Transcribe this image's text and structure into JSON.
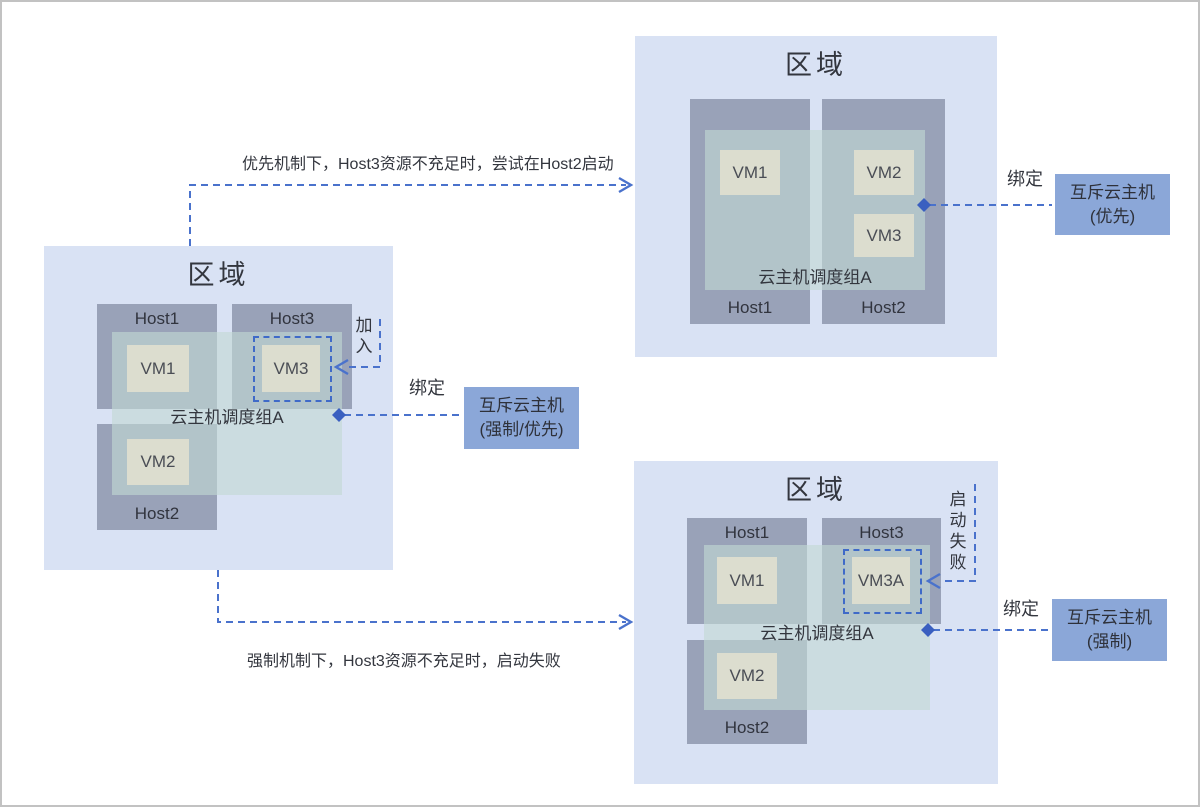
{
  "notes": {
    "priority": "优先机制下，Host3资源不充足时，尝试在Host2启动",
    "mandatory": "强制机制下，Host3资源不充足时，启动失败"
  },
  "labels": {
    "bind": "绑定",
    "join": "加入",
    "start_fail": "启动失败"
  },
  "zones": {
    "left": {
      "title": "区域",
      "group": "云主机调度组A",
      "hosts": {
        "host1": "Host1",
        "host2": "Host2",
        "host3": "Host3"
      },
      "vms": {
        "vm1": "VM1",
        "vm2": "VM2",
        "vm3": "VM3"
      }
    },
    "top_right": {
      "title": "区域",
      "group": "云主机调度组A",
      "hosts": {
        "host1": "Host1",
        "host2": "Host2"
      },
      "vms": {
        "vm1": "VM1",
        "vm2": "VM2",
        "vm3": "VM3"
      }
    },
    "bottom_right": {
      "title": "区域",
      "group": "云主机调度组A",
      "hosts": {
        "host1": "Host1",
        "host2": "Host2",
        "host3": "Host3"
      },
      "vms": {
        "vm1": "VM1",
        "vm2": "VM2",
        "vm3a": "VM3A"
      }
    }
  },
  "badges": {
    "left": {
      "line1": "互斥云主机",
      "line2": "(强制/优先)"
    },
    "top_right": {
      "line1": "互斥云主机",
      "line2": "(优先)"
    },
    "bottom_right": {
      "line1": "互斥云主机",
      "line2": "(强制)"
    }
  },
  "colors": {
    "zone_bg": "#d9e2f4",
    "host_bg": "#99a2b8",
    "vm_bg": "#dcddcf",
    "group_overlay": "#c1d9d3",
    "badge_bg": "#8ba7d8",
    "connector_blue": "#4a72cc",
    "diamond_blue": "#3a5fc0",
    "frame_border": "#c2c2c2"
  }
}
